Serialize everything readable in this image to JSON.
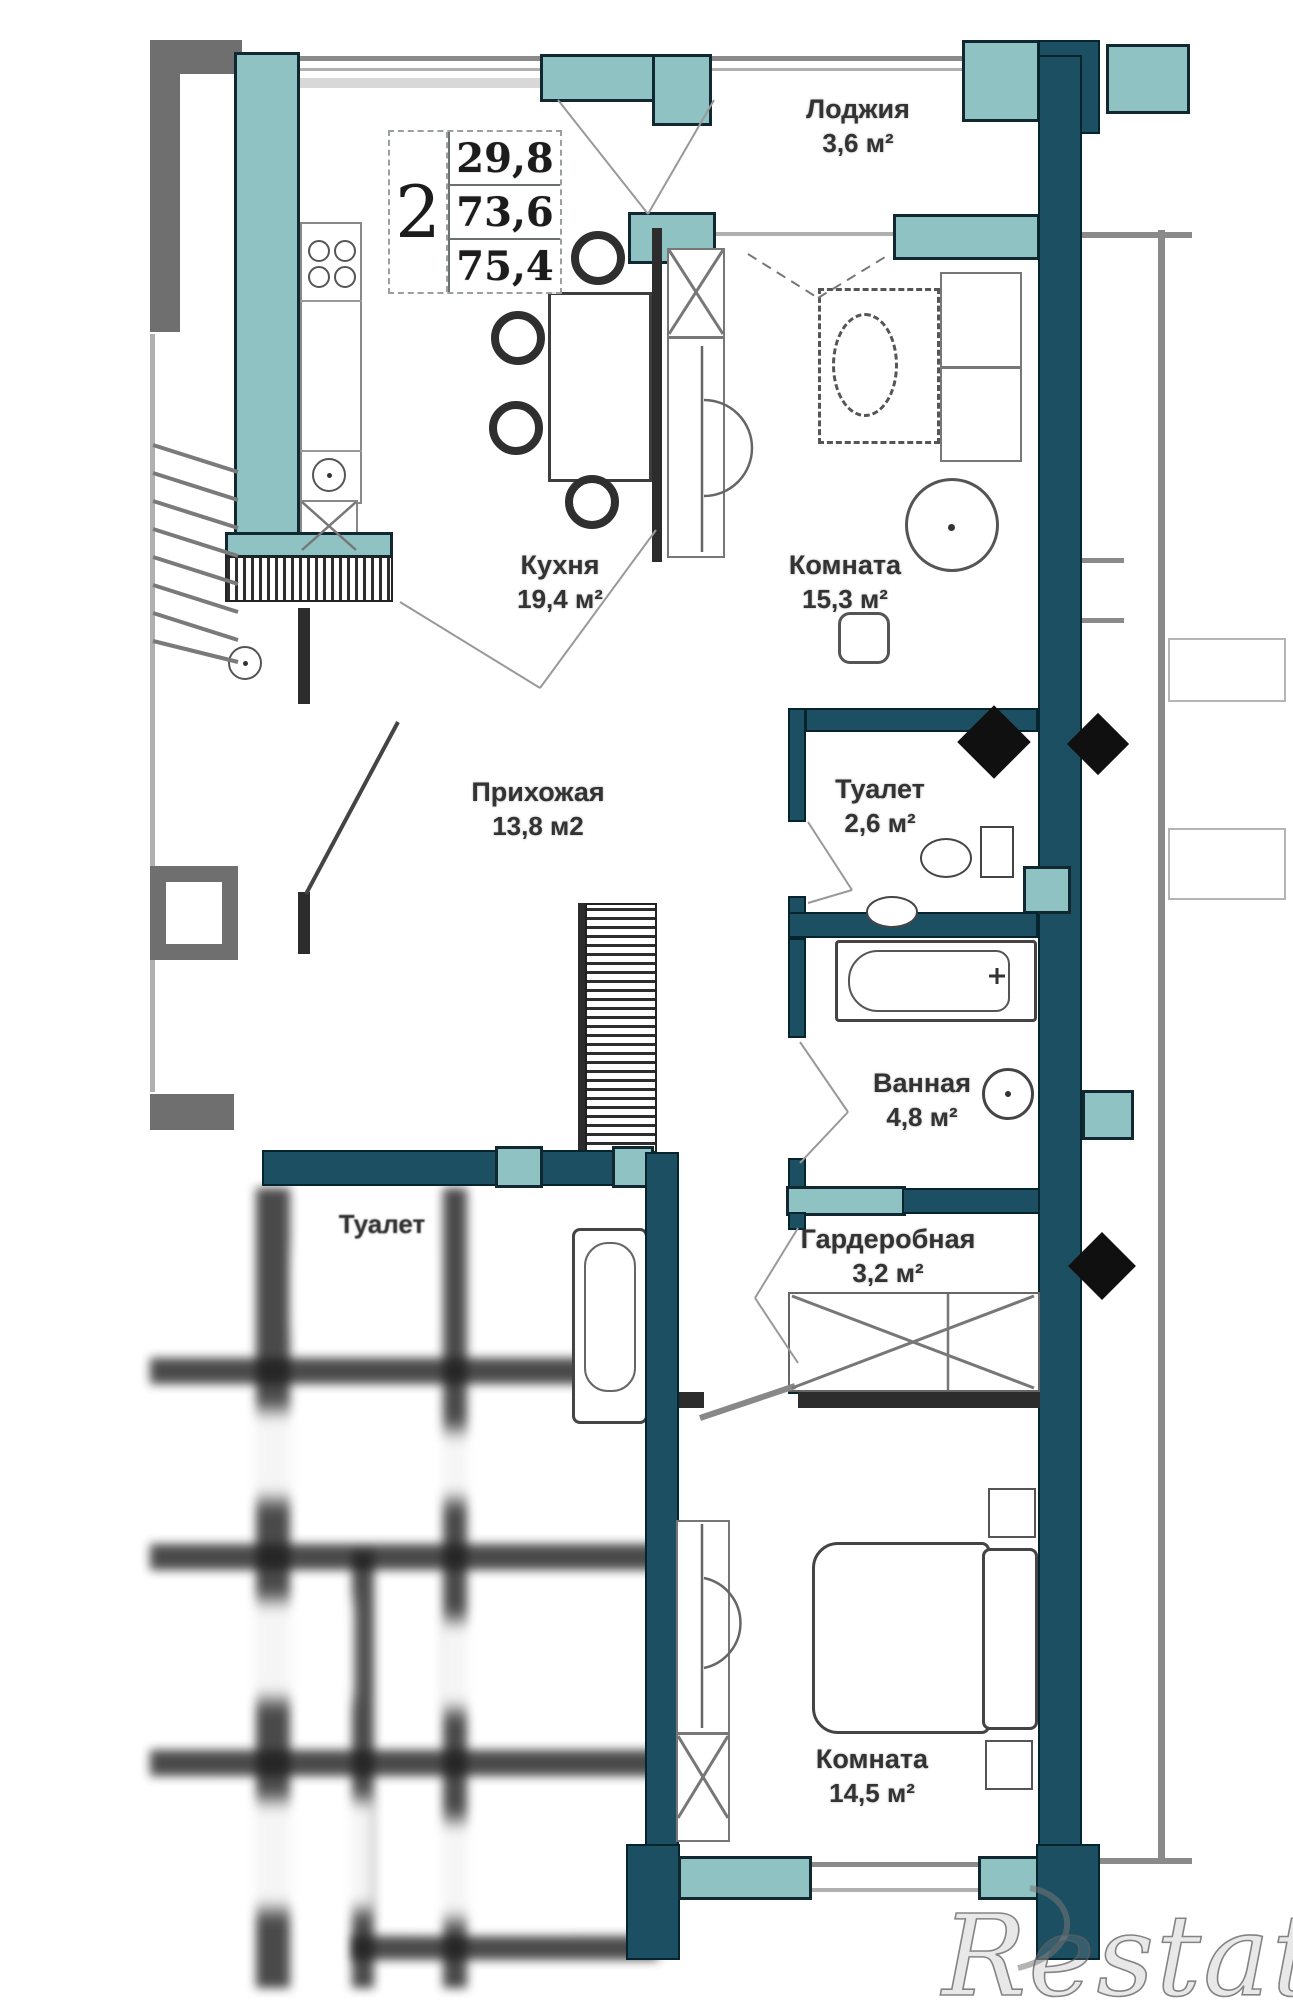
{
  "plan": {
    "stamp": {
      "rooms_count": "2",
      "area_living": "29,8",
      "area_usable": "73,6",
      "area_total": "75,4"
    },
    "rooms": [
      {
        "id": "loggia",
        "name": "Лоджия",
        "area": "3,6 м²"
      },
      {
        "id": "kitchen",
        "name": "Кухня",
        "area": "19,4 м²"
      },
      {
        "id": "room-1",
        "name": "Комната",
        "area": "15,3 м²"
      },
      {
        "id": "hallway",
        "name": "Прихожая",
        "area": "13,8 м2"
      },
      {
        "id": "wc",
        "name": "Туалет",
        "area": "2,6 м²"
      },
      {
        "id": "bathroom",
        "name": "Ванная",
        "area": "4,8 м²"
      },
      {
        "id": "wardrobe",
        "name": "Гардеробная",
        "area": "3,2 м²"
      },
      {
        "id": "room-2",
        "name": "Комната",
        "area": "14,5 м²"
      },
      {
        "id": "neighbor-wc",
        "name": "Туалет",
        "area": ""
      }
    ],
    "watermark": "Restate",
    "colors": {
      "wall_teal": "#8fc3c3",
      "wall_navy": "#1d4f63",
      "wall_gray": "#6f6f6f"
    }
  }
}
